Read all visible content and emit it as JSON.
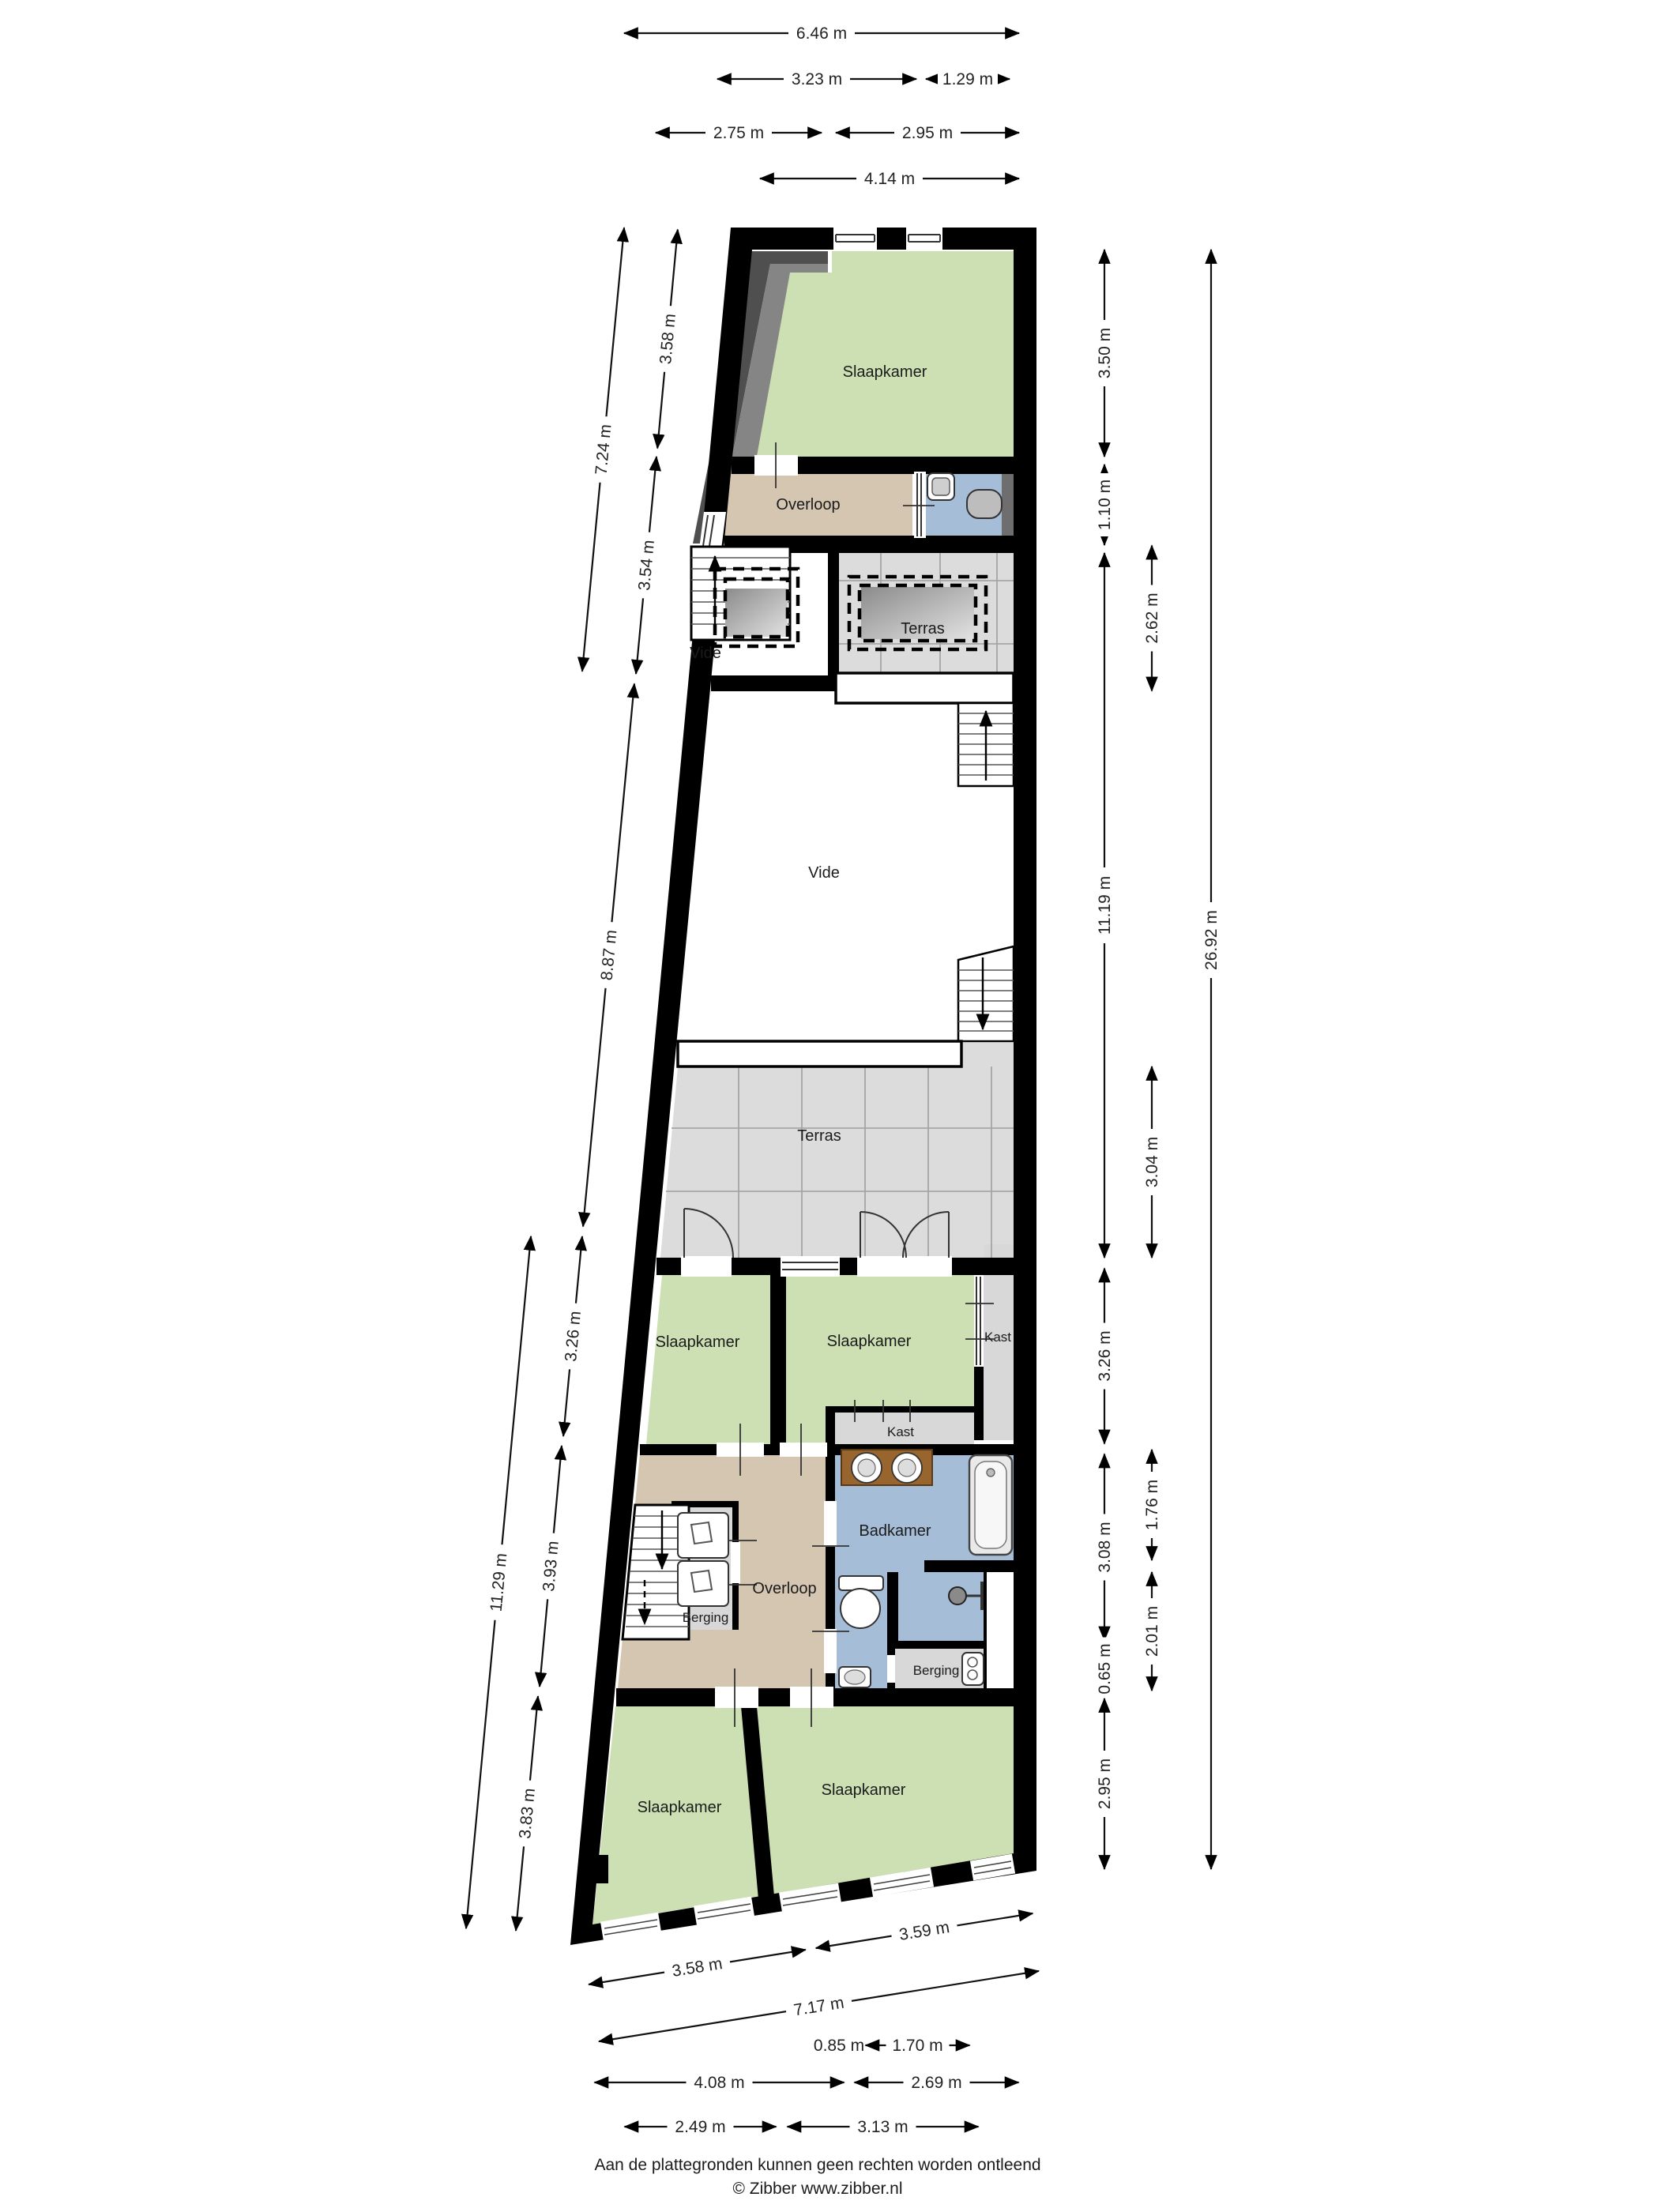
{
  "plan_title": "floor-plan",
  "rooms": {
    "slaapkamer": "Slaapkamer",
    "overloop": "Overloop",
    "vide": "Vide",
    "terras": "Terras",
    "kast": "Kast",
    "badkamer": "Badkamer",
    "berging": "Berging"
  },
  "dims": {
    "top": [
      "6.46 m",
      "3.23 m",
      "1.29 m",
      "2.75 m",
      "2.95 m",
      "4.14 m"
    ],
    "left": [
      "7.24 m",
      "3.58 m",
      "3.54 m",
      "8.87 m",
      "3.26 m",
      "11.29 m",
      "3.93 m",
      "3.83 m"
    ],
    "right": [
      "3.50 m",
      "1.10 m",
      "11.19 m",
      "3.26 m",
      "3.08 m",
      "0.65 m",
      "2.95 m",
      "2.62 m",
      "3.04 m",
      "1.76 m",
      "2.01 m",
      "26.92 m"
    ],
    "bottom": [
      "3.58 m",
      "3.59 m",
      "7.17 m",
      "0.85 m",
      "1.70 m",
      "4.08 m",
      "2.69 m",
      "2.49 m",
      "3.13 m"
    ]
  },
  "footer": {
    "disclaimer": "Aan de plattegronden kunnen geen rechten worden ontleend",
    "credit": "© Zibber www.zibber.nl"
  },
  "colors": {
    "room_green": "#cde0b4",
    "room_tan": "#d5c6b2",
    "room_blue": "#a6bdd8",
    "tile_gray": "#dcdcdc",
    "closet_gray": "#d8d8d8",
    "counter_wood": "#99652f",
    "wall_black": "#000000",
    "wedge_dark": "#4f4f4f",
    "wedge_light": "#858585",
    "duct_gray": "#6e6e6e"
  }
}
